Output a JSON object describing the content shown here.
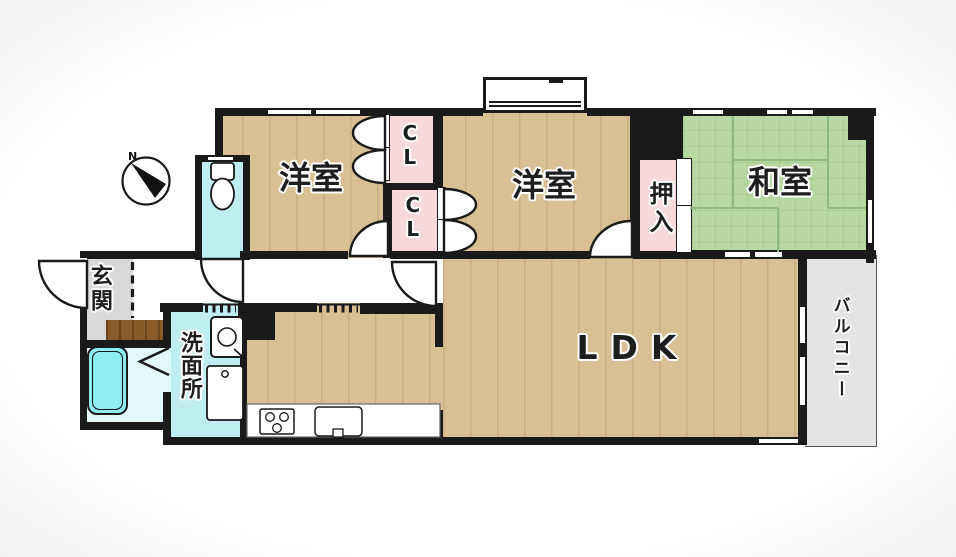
{
  "labels": {
    "bedroom_west": "洋室",
    "bedroom_center": "洋室",
    "japanese_room": "和室",
    "ldk": "LDK",
    "oshiire": "押入",
    "closet_upper": "CL",
    "closet_lower": "CL",
    "entrance": "玄関",
    "washroom": "洗面所",
    "balcony": "バルコニー",
    "compass_north": "N"
  },
  "colors": {
    "wall": "#1a1a1a",
    "wood_floor": "#d9c094",
    "tatami_green": "#b7d9a1",
    "closet_pink": "#f7d9dc",
    "water_cyan": "#bfeef1",
    "entrance_gray": "#d9d9d7",
    "balcony_gray": "#e4e4e2",
    "step_brown": "#8a5a28"
  }
}
